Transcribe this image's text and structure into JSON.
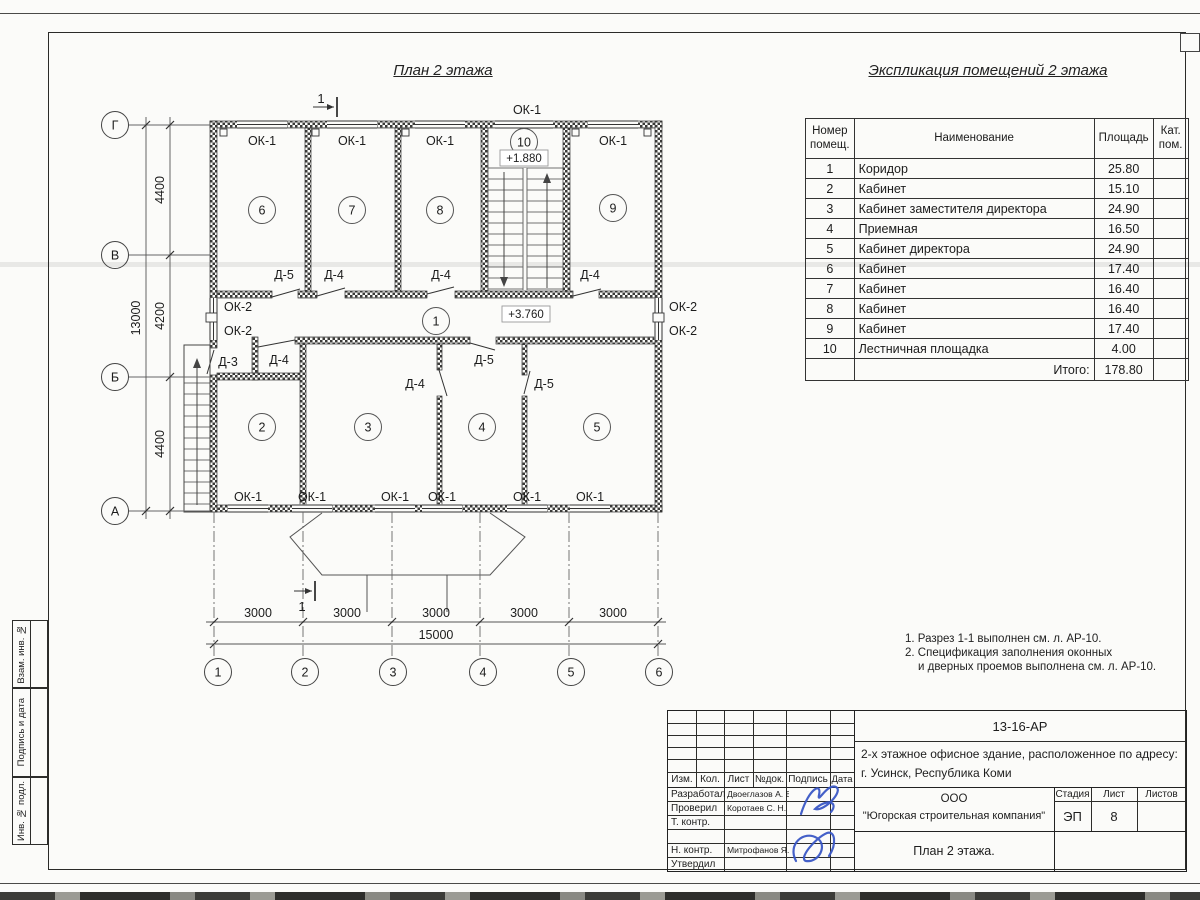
{
  "page": {
    "plan_title": "План 2 этажа",
    "table_title": "Экспликация помещений 2 этажа"
  },
  "colors": {
    "paper": "#fbfbf9",
    "ink": "#2b2b29",
    "signature_blue": "#3a57c5"
  },
  "table": {
    "headers": {
      "num": "Номер помещ.",
      "name": "Наименование",
      "area": "Площадь",
      "cat": "Кат. пом."
    },
    "rows": [
      {
        "num": "1",
        "name": "Коридор",
        "area": "25.80"
      },
      {
        "num": "2",
        "name": "Кабинет",
        "area": "15.10"
      },
      {
        "num": "3",
        "name": "Кабинет заместителя директора",
        "area": "24.90"
      },
      {
        "num": "4",
        "name": "Приемная",
        "area": "16.50"
      },
      {
        "num": "5",
        "name": "Кабинет директора",
        "area": "24.90"
      },
      {
        "num": "6",
        "name": "Кабинет",
        "area": "17.40"
      },
      {
        "num": "7",
        "name": "Кабинет",
        "area": "16.40"
      },
      {
        "num": "8",
        "name": "Кабинет",
        "area": "16.40"
      },
      {
        "num": "9",
        "name": "Кабинет",
        "area": "17.40"
      },
      {
        "num": "10",
        "name": "Лестничная площадка",
        "area": "4.00"
      }
    ],
    "total_label": "Итого:",
    "total_value": "178.80"
  },
  "plan": {
    "labels": {
      "ok1": "ОК-1",
      "ok2": "ОК-2",
      "d3": "Д-3",
      "d4": "Д-4",
      "d5": "Д-5"
    },
    "levels": {
      "stair": "+1.880",
      "corridor": "+3.760"
    },
    "section": "1",
    "rooms": [
      "1",
      "2",
      "3",
      "4",
      "5",
      "6",
      "7",
      "8",
      "9",
      "10"
    ],
    "axes": {
      "letters": [
        "Г",
        "В",
        "Б",
        "А"
      ],
      "numbers": [
        "1",
        "2",
        "3",
        "4",
        "5",
        "6"
      ]
    },
    "dims": {
      "d3000": "3000",
      "d15000": "15000",
      "d4400": "4400",
      "d4200": "4200",
      "d13000": "13000"
    }
  },
  "notes": {
    "l1": "1. Разрез 1-1 выполнен см. л. АР-10.",
    "l2": "2. Спецификация заполнения оконных",
    "l3": "и дверных проемов выполнена см. л. АР-10."
  },
  "titleblock": {
    "doc_number": "13-16-АР",
    "description_line1": "2-х этажное офисное здание, расположенное по адресу:",
    "description_line2": "г. Усинск, Республика Коми",
    "company_line1": "ООО",
    "company_line2": "\"Югорская строительная компания\"",
    "drawing_name": "План 2 этажа.",
    "stage_label": "Стадия",
    "sheet_label": "Лист",
    "sheets_label": "Листов",
    "stage_value": "ЭП",
    "sheet_value": "8",
    "cols": {
      "izm": "Изм.",
      "kol": "Кол.",
      "list": "Лист",
      "ndoc": "№док.",
      "sign": "Подпись",
      "date": "Дата"
    },
    "roles": [
      {
        "label": "Разработал",
        "name": "Двоеглазов А. В."
      },
      {
        "label": "Проверил",
        "name": "Коротаев С. Н."
      },
      {
        "label": "Т. контр.",
        "name": ""
      },
      {
        "label": "",
        "name": ""
      },
      {
        "label": "Н. контр.",
        "name": "Митрофанов Я. А."
      },
      {
        "label": "Утвердил",
        "name": ""
      }
    ]
  },
  "side_strip": {
    "labels": [
      "Инв. № подл.",
      "Подпись и дата",
      "Взам. инв. №"
    ]
  }
}
